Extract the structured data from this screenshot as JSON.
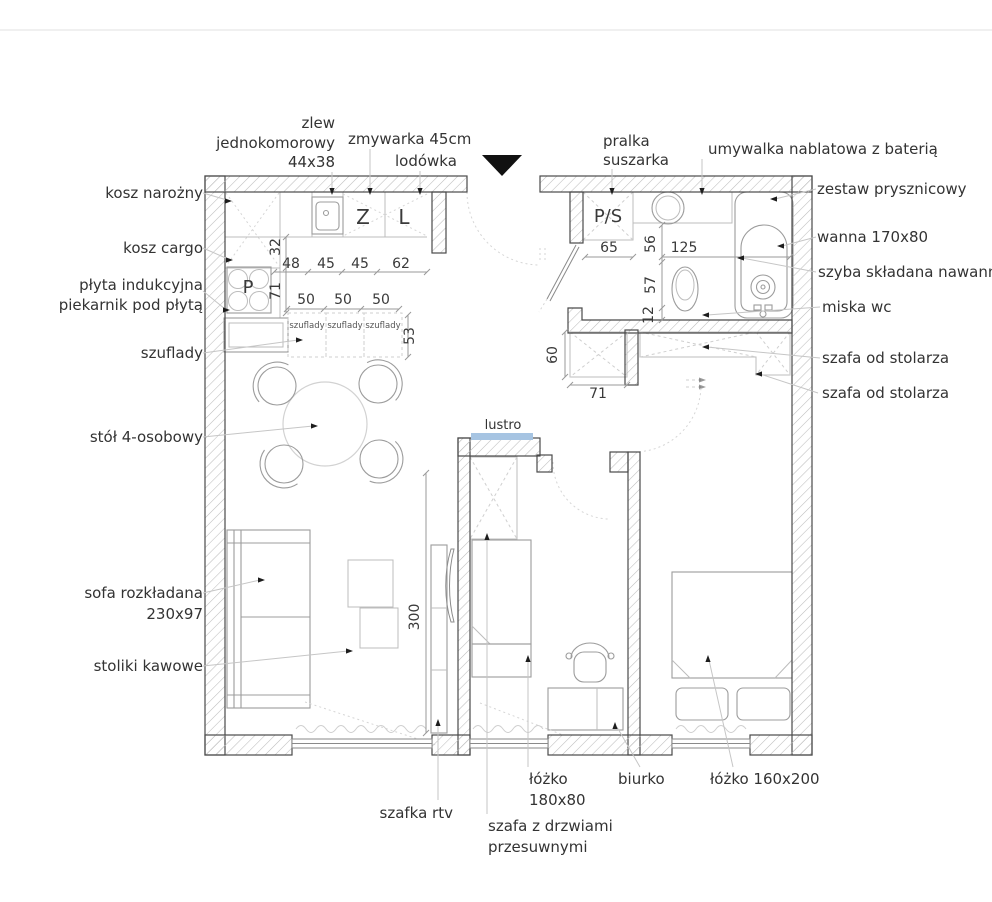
{
  "annotations": {
    "zlew_line1": "zlew",
    "zlew_line2": "jednokomorowy",
    "zlew_line3": "44x38",
    "zmywarka": "zmywarka 45cm",
    "lodowka": "lodówka",
    "pralka_line1": "pralka",
    "pralka_line2": "suszarka",
    "umywalka": "umywalka nablatowa z baterią",
    "zestaw_prysznicowy": "zestaw prysznicowy",
    "wanna": "wanna 170x80",
    "szyba": "szyba składana nawann",
    "miska_wc": "miska wc",
    "szafa_stolarz_top": "szafa od stolarza",
    "szafa_stolarz_bottom": "szafa od stolarza",
    "kosz_narozny": "kosz narożny",
    "kosz_cargo": "kosz cargo",
    "plyta_line1": "płyta indukcyjna",
    "plyta_line2": "piekarnik pod płytą",
    "szuflady_label": "szuflady",
    "stol": "stół 4-osobowy",
    "sofa_line1": "sofa rozkładana",
    "sofa_line2": "230x97",
    "stoliki_kawowe": "stoliki kawowe",
    "szafka_rtv": "szafka rtv",
    "lozko_180_line1": "łóżko",
    "lozko_180_line2": "180x80",
    "szafa_przesuwna_line1": "szafa z drzwiami",
    "szafa_przesuwna_line2": "przesuwnymi",
    "biurko": "biurko",
    "lozko_160": "łóżko 160x200",
    "lustro": "lustro"
  },
  "markers": {
    "zmywarka": "Z",
    "lodowka": "L",
    "plyta": "P",
    "pralka_suszarka": "P/S"
  },
  "drawer_units": {
    "unit1": "szuflady",
    "unit2": "szuflady",
    "unit3": "szuflady"
  },
  "dimensions": {
    "d32": "32",
    "d48": "48",
    "d45a": "45",
    "d45b": "45",
    "d62": "62",
    "d71_kitchen": "71",
    "d50a": "50",
    "d50b": "50",
    "d50c": "50",
    "d53": "53",
    "d65": "65",
    "d56": "56",
    "d125": "125",
    "d57": "57",
    "d12": "12",
    "d60": "60",
    "d71_hall": "71",
    "d300": "300"
  },
  "colors": {
    "mirror_blue": "#a6c4e2",
    "wall_outline": "#4a4a4a",
    "hatch": "#bdbdbd",
    "furniture": "#9c9c9c",
    "text": "#333333"
  }
}
